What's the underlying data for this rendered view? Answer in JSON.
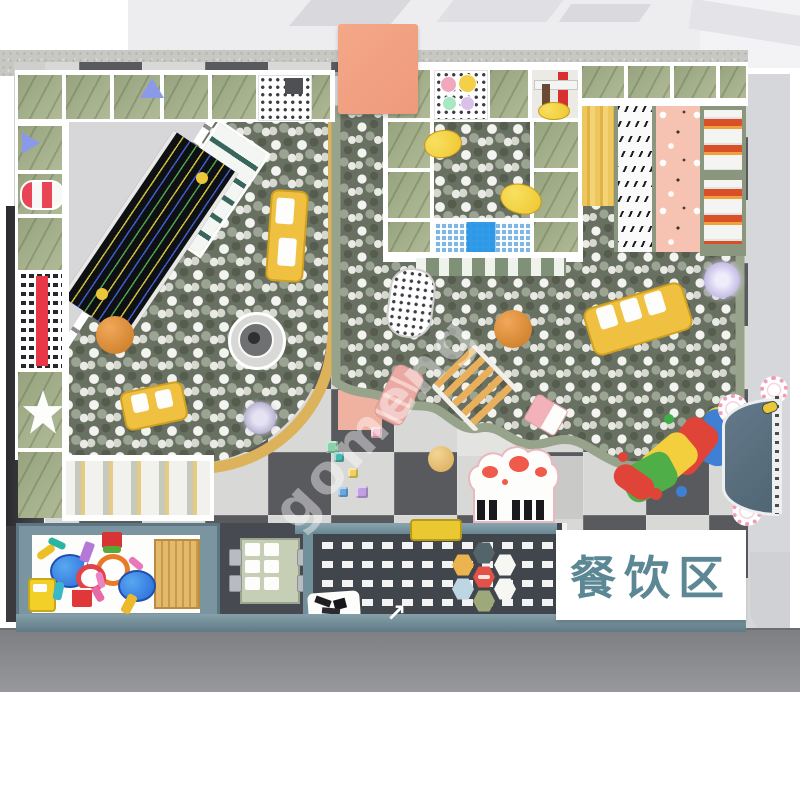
{
  "sign": {
    "label": "餐饮区"
  },
  "watermark": {
    "text": "gomeng"
  },
  "icons": {
    "arrow_decal": "↗"
  },
  "palette": {
    "wall_band": "#c7c7c3",
    "wall_dark": "#35353a",
    "mat_dark": "#595a5e",
    "mat_light": "#d8d8d6",
    "mat_pink": "#f0b2a0",
    "ballpit_base": "#687062",
    "ball_highlight": "#f3f3ef",
    "pit_rim_tan": "#dcb25a",
    "pit_rim_sage": "#97a38b",
    "structure_sage": "#a0ac86",
    "slide_wood_yellow": "#ecc35c",
    "slide_pink": "#f6c4b4",
    "roller_red": "#d84f28",
    "platform_slate": "#41464d",
    "platform_teal": "#7b97a1",
    "sandbox_frame": "#7b95a0",
    "bench_yellow": "#e9c832",
    "disc_teal": "#5d7280",
    "block_salmon": "#f2a083",
    "sign_text": "#5c8795",
    "caterpillar": [
      "#3f7fd4",
      "#e04438",
      "#f3cf3e",
      "#4fae48"
    ]
  }
}
